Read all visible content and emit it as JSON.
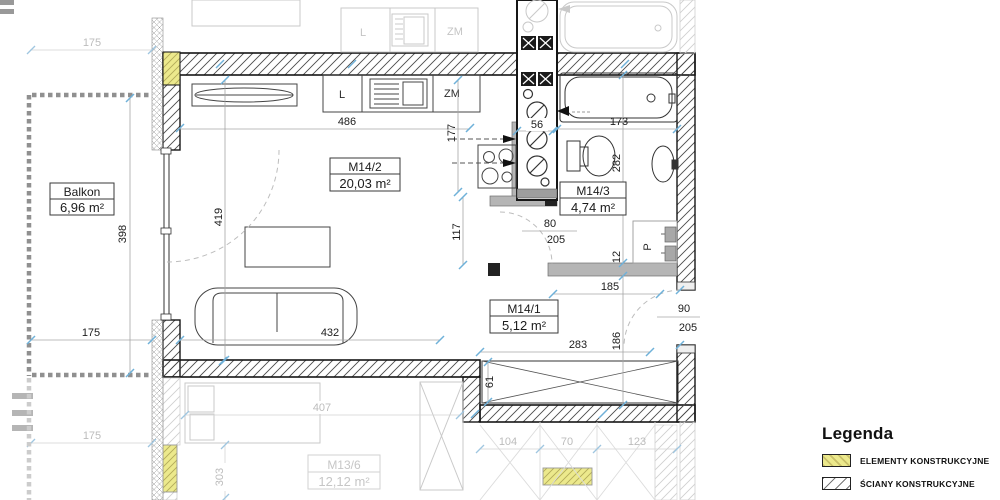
{
  "plan": {
    "rooms": {
      "balkon": {
        "name": "Balkon",
        "area": "6,96 m²"
      },
      "m14_2": {
        "name": "M14/2",
        "area": "20,03 m²"
      },
      "m14_3": {
        "name": "M14/3",
        "area": "4,74 m²"
      },
      "m14_1": {
        "name": "M14/1",
        "area": "5,12 m²"
      },
      "m13_6": {
        "name": "M13/6",
        "area": "12,12 m²"
      }
    },
    "labels": {
      "kitchen_l": "L",
      "kitchen_zm": "ZM",
      "neighbor_l": "L",
      "neighbor_zm": "ZM",
      "washer": "P"
    },
    "dims": {
      "kitchen_width": "486",
      "kitchen_depth": "177",
      "room_left": "419",
      "room_mid": "117",
      "sofa_width": "432",
      "shaft_width": "56",
      "tub_width": "173",
      "bath_depth": "282",
      "bath_door_width": "80",
      "bath_door_height": "205",
      "wall_offset": "12",
      "hall_width": "185",
      "entry_width": "90",
      "entry_height": "205",
      "hall_length": "283",
      "hall_depth": "186",
      "wardrobe_depth": "61",
      "balcony_width": "175",
      "balcony_depth": "398"
    },
    "neighbor_dims": {
      "top_175": "175",
      "bottom_175": "175",
      "d407": "407",
      "d303": "303",
      "d104": "104",
      "d70": "70",
      "d123": "123"
    }
  },
  "legend": {
    "title": "Legenda",
    "items": [
      {
        "label": "ELEMENTY KONSTRUKCYJNE"
      },
      {
        "label": "ŚCIANY KONSTRUKCYJNE"
      },
      {
        "label": "ŚCIANY DZIAŁOWE (możliwość"
      }
    ]
  },
  "colors": {
    "tick_blue": "#6fb1d9",
    "structural_yellow": "#ece98c",
    "partition_gray": "#b5b5b5",
    "neighbor_gray": "#c9c9c9"
  }
}
